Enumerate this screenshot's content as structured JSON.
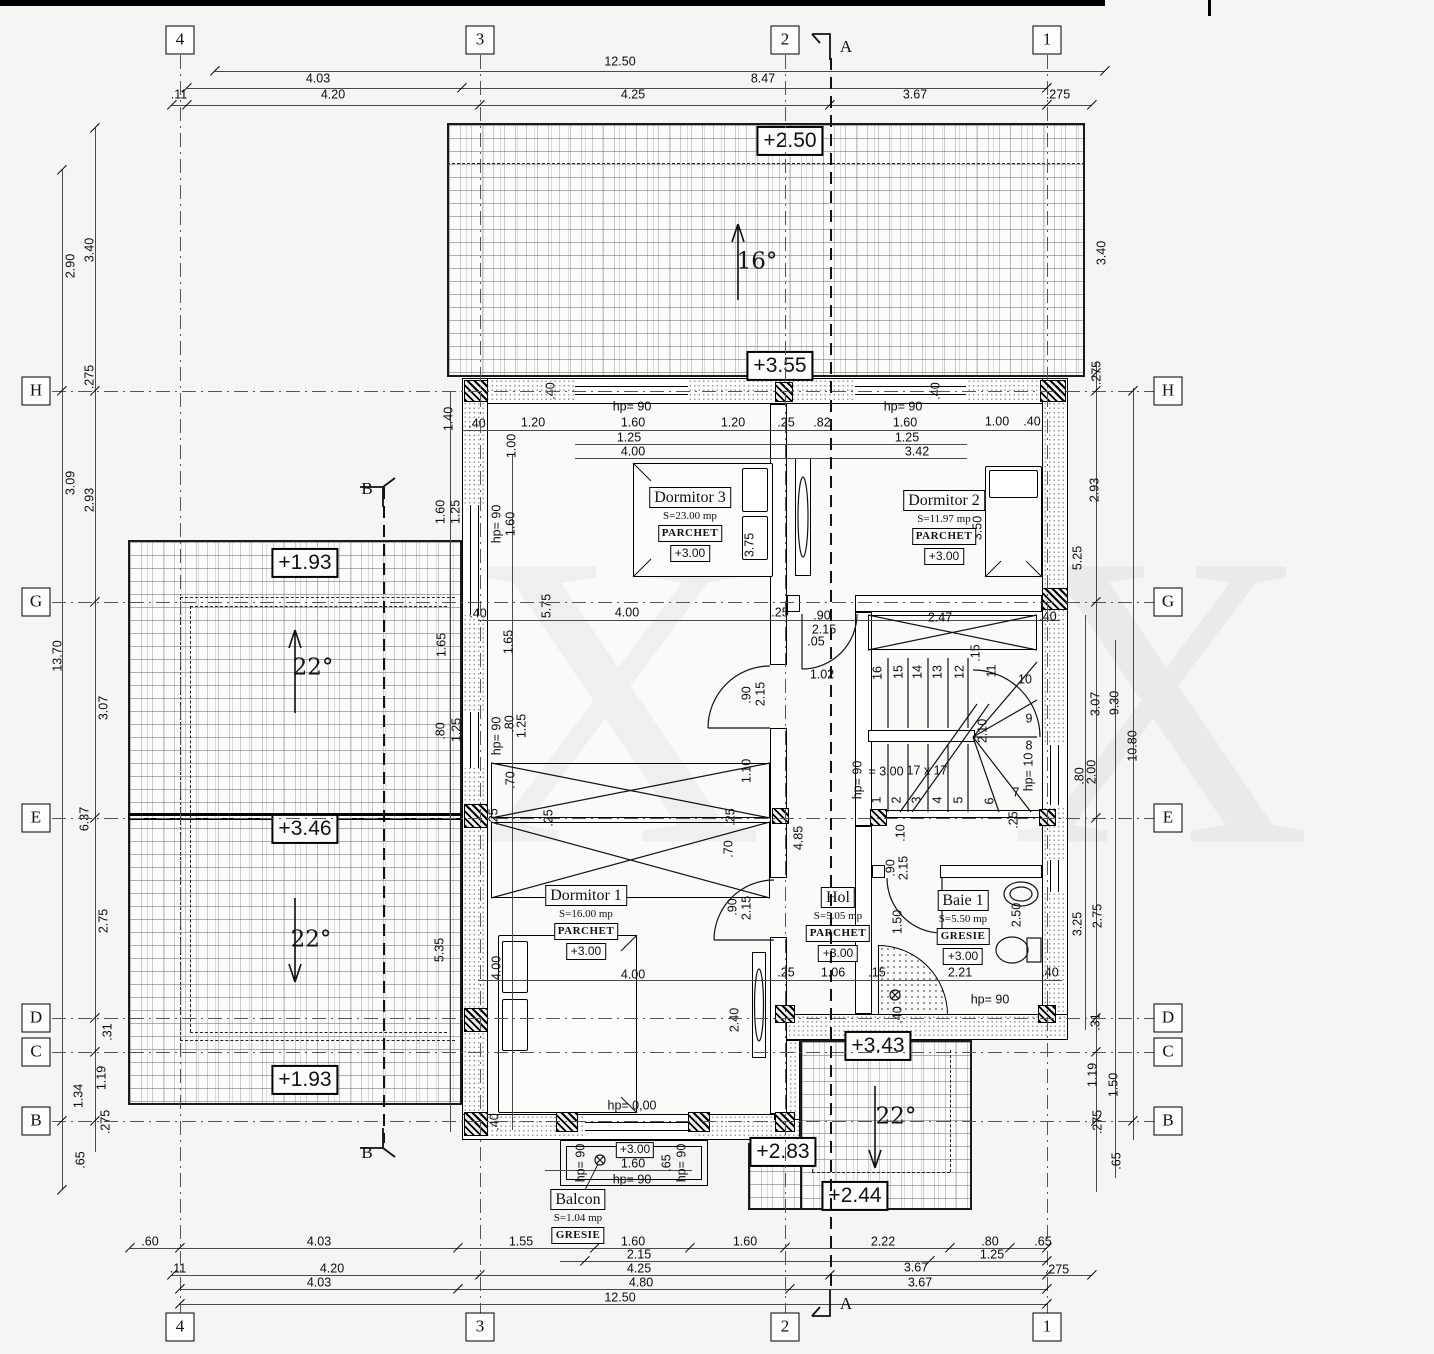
{
  "axes": {
    "cols": [
      [
        "4",
        180
      ],
      [
        "3",
        480
      ],
      [
        "2",
        785
      ],
      [
        "1",
        1047
      ]
    ],
    "rows": [
      [
        "H",
        391
      ],
      [
        "G",
        602
      ],
      [
        "E",
        818
      ],
      [
        "D",
        1018
      ],
      [
        "C",
        1052
      ],
      [
        "B",
        1121
      ]
    ],
    "colMarkerY": [
      40,
      1327
    ],
    "rowMarkerX": [
      36,
      1168
    ],
    "colLine": [
      55,
      1315
    ],
    "rowLine": [
      52,
      1180
    ],
    "sections": [
      {
        "label": "A",
        "x": 830,
        "y1": 58,
        "y2": 1292,
        "lx": 846,
        "lyTop": 47,
        "lyBot": 1304
      },
      {
        "label": "B",
        "x": 383,
        "y1": 487,
        "y2": 1143,
        "lx": 367,
        "lyTop": 489,
        "lyBot": 1153
      }
    ]
  },
  "rooms": [
    {
      "name": "Dormitor 3",
      "area": "S=23.00 mp",
      "finish": "PARCHET",
      "level": "+3.00",
      "cx": 690,
      "cy": 497
    },
    {
      "name": "Dormitor 2",
      "area": "S=11.97 mp",
      "finish": "PARCHET",
      "level": "+3.00",
      "cx": 944,
      "cy": 500
    },
    {
      "name": "Dormitor 1",
      "area": "S=16.00 mp",
      "finish": "PARCHET",
      "level": "+3.00",
      "cx": 586,
      "cy": 895
    },
    {
      "name": "Hol",
      "area": "S=5.05 mp",
      "finish": "PARCHET",
      "level": "+3.00",
      "cx": 838,
      "cy": 897
    },
    {
      "name": "Baie 1",
      "area": "S=5.50 mp",
      "finish": "GRESIE",
      "level": "+3.00",
      "cx": 963,
      "cy": 900
    },
    {
      "name": "Balcon",
      "area": "S=1.04 mp",
      "finish": "GRESIE",
      "level": null,
      "cx": 578,
      "cy": 1199
    }
  ],
  "elevations": [
    [
      "+2.50",
      790,
      141
    ],
    [
      "+3.55",
      780,
      366
    ],
    [
      "+1.93",
      305,
      563
    ],
    [
      "+3.46",
      305,
      829
    ],
    [
      "+1.93",
      305,
      1080
    ],
    [
      "+3.43",
      878,
      1046
    ],
    [
      "+2.83",
      783,
      1152
    ],
    [
      "+2.44",
      855,
      1196
    ],
    [
      "+3.00",
      635,
      1150,
      "sm"
    ]
  ],
  "slopes": [
    [
      "16°",
      757,
      262
    ],
    [
      "22°",
      313,
      668
    ],
    [
      "22°",
      311,
      940
    ],
    [
      "22°",
      896,
      1117
    ]
  ],
  "watermark": [
    [
      "X",
      612,
      700
    ],
    [
      "X",
      1160,
      700
    ]
  ],
  "dims": [
    [
      "12.50",
      620,
      62
    ],
    [
      "4.03",
      318,
      79
    ],
    [
      "8.47",
      763,
      79
    ],
    [
      ".11",
      179,
      95
    ],
    [
      "4.20",
      333,
      95
    ],
    [
      "4.25",
      633,
      95
    ],
    [
      "3.67",
      915,
      95
    ],
    [
      ".275",
      1058,
      95
    ],
    [
      ".60",
      150,
      1242
    ],
    [
      "4.03",
      319,
      1242
    ],
    [
      "1.55",
      521,
      1242
    ],
    [
      "1.60",
      633,
      1242
    ],
    [
      "1.60",
      745,
      1242
    ],
    [
      "2.22",
      883,
      1242
    ],
    [
      ".80",
      990,
      1242
    ],
    [
      ".65",
      1043,
      1242
    ],
    [
      "2.15",
      639,
      1255
    ],
    [
      "1.25",
      992,
      1255
    ],
    [
      ".11",
      178,
      1269
    ],
    [
      "4.20",
      332,
      1269
    ],
    [
      "4.25",
      639,
      1269
    ],
    [
      "3.67",
      916,
      1268
    ],
    [
      ".275",
      1057,
      1270
    ],
    [
      "4.03",
      319,
      1283
    ],
    [
      "4.80",
      641,
      1283
    ],
    [
      "3.67",
      920,
      1283
    ],
    [
      "12.50",
      620,
      1298
    ],
    [
      "3.40",
      90,
      250,
      1
    ],
    [
      "2.90",
      71,
      266,
      1
    ],
    [
      ".275",
      90,
      377,
      1
    ],
    [
      "3.09",
      71,
      483,
      1
    ],
    [
      "2.93",
      90,
      500,
      1
    ],
    [
      "13.70",
      58,
      656,
      1
    ],
    [
      "3.07",
      104,
      708,
      1
    ],
    [
      "6.37",
      85,
      819,
      1
    ],
    [
      "2.75",
      104,
      921,
      1
    ],
    [
      ".31",
      108,
      1032,
      1
    ],
    [
      "1.19",
      102,
      1078,
      1
    ],
    [
      "1.34",
      79,
      1096,
      1
    ],
    [
      ".275",
      106,
      1122,
      1
    ],
    [
      ".65",
      81,
      1160,
      1
    ],
    [
      "3.40",
      1102,
      253,
      1
    ],
    [
      ".275",
      1097,
      373,
      1
    ],
    [
      "2.93",
      1095,
      490,
      1
    ],
    [
      "5.25",
      1078,
      558,
      1
    ],
    [
      "3.07",
      1096,
      704,
      1
    ],
    [
      "9.30",
      1115,
      703,
      1
    ],
    [
      "10.80",
      1133,
      746,
      1
    ],
    [
      ".80",
      1080,
      776,
      1
    ],
    [
      "2.00",
      1092,
      772,
      1
    ],
    [
      "2.75",
      1098,
      916,
      1
    ],
    [
      "3.25",
      1078,
      924,
      1
    ],
    [
      ".31",
      1096,
      1022,
      1
    ],
    [
      "1.19",
      1093,
      1075,
      1
    ],
    [
      "1.50",
      1114,
      1085,
      1
    ],
    [
      ".275",
      1098,
      1122,
      1
    ],
    [
      ".65",
      1117,
      1161,
      1
    ],
    [
      "hp= 90",
      632,
      407
    ],
    [
      "hp= 90",
      903,
      407
    ],
    [
      ".40",
      477,
      424
    ],
    [
      "1.20",
      533,
      423
    ],
    [
      "1.60",
      633,
      423
    ],
    [
      "1.20",
      733,
      423
    ],
    [
      ".25",
      786,
      423
    ],
    [
      ".82",
      822,
      423
    ],
    [
      "1.60",
      905,
      423
    ],
    [
      "1.00",
      997,
      422
    ],
    [
      ".40",
      1032,
      422
    ],
    [
      "1.25",
      629,
      438
    ],
    [
      "1.25",
      907,
      438
    ],
    [
      "4.00",
      633,
      452
    ],
    [
      "3.42",
      917,
      452
    ],
    [
      "1.40",
      449,
      419,
      1
    ],
    [
      "1.00",
      512,
      446,
      1
    ],
    [
      ".40",
      551,
      391,
      1
    ],
    [
      ".40",
      936,
      391,
      1
    ],
    [
      "1.60",
      441,
      512,
      1
    ],
    [
      "1.25",
      456,
      512,
      1
    ],
    [
      "hp= 90",
      497,
      524,
      1
    ],
    [
      "1.60",
      511,
      524,
      1
    ],
    [
      "1.65",
      442,
      645,
      1
    ],
    [
      "1.65",
      509,
      642,
      1
    ],
    [
      ".40",
      478,
      614
    ],
    [
      "5.75",
      547,
      606,
      1
    ],
    [
      ".80",
      441,
      731,
      1
    ],
    [
      "1.25",
      457,
      730,
      1
    ],
    [
      "hp= 90",
      497,
      736,
      1
    ],
    [
      ".80",
      510,
      724,
      1
    ],
    [
      "1.25",
      522,
      726,
      1
    ],
    [
      "4.00",
      627,
      613
    ],
    [
      ".25",
      780,
      613
    ],
    [
      ".90",
      822,
      616
    ],
    [
      "2.15",
      824,
      630
    ],
    [
      ".05",
      816,
      642
    ],
    [
      "1.02",
      822,
      675
    ],
    [
      "2.47",
      940,
      618
    ],
    [
      ".40",
      1048,
      617
    ],
    [
      ".15",
      976,
      653,
      1
    ],
    [
      ".90",
      747,
      695,
      1
    ],
    [
      "2.15",
      761,
      694,
      1
    ],
    [
      "2.10",
      983,
      731,
      1
    ],
    [
      "hp= 90",
      858,
      780,
      1
    ],
    [
      "hp= 10",
      1029,
      772,
      1
    ],
    [
      "= 3,00",
      886,
      772
    ],
    [
      "17 x 17",
      927,
      771
    ],
    [
      "1.10",
      747,
      771,
      1
    ],
    [
      ".70",
      511,
      780,
      1
    ],
    [
      ".25",
      494,
      817,
      1
    ],
    [
      ".25",
      549,
      818,
      1
    ],
    [
      ".25",
      731,
      817,
      1
    ],
    [
      ".10",
      901,
      833,
      1
    ],
    [
      ".25",
      1014,
      820,
      1
    ],
    [
      "4.85",
      799,
      838,
      1
    ],
    [
      ".70",
      729,
      849,
      1
    ],
    [
      "1",
      877,
      800,
      1
    ],
    [
      "2",
      897,
      800,
      1
    ],
    [
      "3",
      917,
      800,
      1
    ],
    [
      "4",
      938,
      800,
      1
    ],
    [
      "5",
      959,
      800,
      1
    ],
    [
      "6",
      990,
      801,
      1
    ],
    [
      "16",
      878,
      673,
      1
    ],
    [
      "15",
      899,
      672,
      1
    ],
    [
      "14",
      918,
      672,
      1
    ],
    [
      "13",
      938,
      672,
      1
    ],
    [
      "12",
      960,
      672,
      1
    ],
    [
      "11",
      992,
      671,
      1
    ],
    [
      "10",
      1025,
      680
    ],
    [
      "9",
      1029,
      719
    ],
    [
      "8",
      1029,
      746
    ],
    [
      "7",
      1016,
      793
    ],
    [
      "3.75",
      750,
      545,
      1
    ],
    [
      "3.50",
      978,
      528,
      1
    ],
    [
      "5.35",
      440,
      950,
      1
    ],
    [
      "4.00",
      497,
      968,
      1
    ],
    [
      "4.00",
      633,
      975
    ],
    [
      "2.40",
      735,
      1020,
      1
    ],
    [
      ".90",
      733,
      907,
      1
    ],
    [
      "2.15",
      747,
      908,
      1
    ],
    [
      ".25",
      786,
      973
    ],
    [
      "1.06",
      833,
      973
    ],
    [
      ".15",
      877,
      973
    ],
    [
      ".90",
      891,
      868,
      1
    ],
    [
      "2.15",
      904,
      868,
      1
    ],
    [
      "1.50",
      898,
      922,
      1
    ],
    [
      "2.50",
      1017,
      915,
      1
    ],
    [
      "2.21",
      960,
      973
    ],
    [
      ".40",
      1050,
      973
    ],
    [
      "hp= 90",
      990,
      1000
    ],
    [
      ".40",
      898,
      1015,
      1
    ],
    [
      "hp= 0,00",
      632,
      1106
    ],
    [
      ".40",
      495,
      1122,
      1
    ],
    [
      "1.60",
      633,
      1164
    ],
    [
      "hp= 90",
      632,
      1180
    ],
    [
      ".65",
      667,
      1163,
      1
    ],
    [
      "hp= 90",
      581,
      1163,
      1
    ],
    [
      "hp= 90",
      682,
      1163,
      1
    ]
  ]
}
